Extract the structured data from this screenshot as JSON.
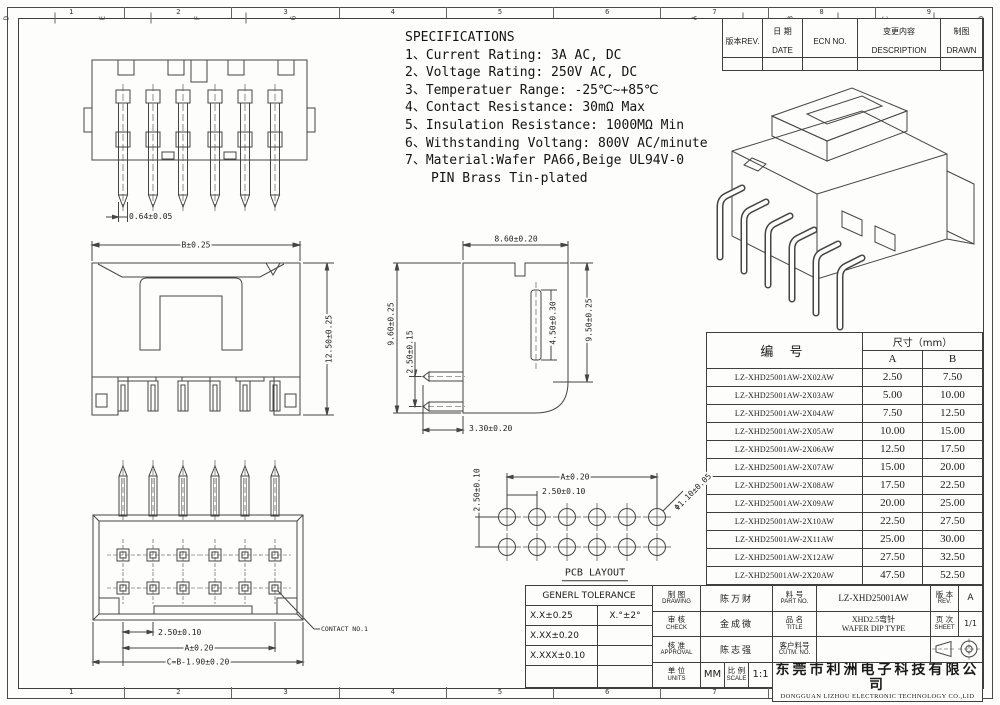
{
  "frame": {
    "cols": [
      "1",
      "2",
      "3",
      "4",
      "5",
      "6",
      "7",
      "8",
      "9"
    ],
    "rows": [
      "A",
      "B",
      "C",
      "D",
      "E",
      "F",
      "G"
    ]
  },
  "specs": {
    "title": "SPECIFICATIONS",
    "lines": [
      "1、Current Rating: 3A AC, DC",
      "2、Voltage Rating: 250V AC, DC",
      "3、Temperatuer Range: -25℃~+85℃",
      "4、Contact Resistance: 30mΩ Max",
      "5、Insulation Resistance: 1000MΩ Min",
      "6、Withstanding Voltang: 800V AC/minute",
      "7、Material:Wafer PA66,Beige UL94V-0",
      "PIN Brass Tin-plated"
    ]
  },
  "rev": {
    "cols": [
      {
        "zh": "版本",
        "en": "REV."
      },
      {
        "zh": "日 期",
        "en": "DATE"
      },
      {
        "zh": "",
        "en": "ECN NO."
      },
      {
        "zh": "变更内容",
        "en": "DESCRIPTION"
      },
      {
        "zh": "制图",
        "en": "DRAWN"
      }
    ]
  },
  "parts": {
    "header": {
      "part": "编  号",
      "dim": "尺寸（mm）",
      "a": "A",
      "b": "B"
    },
    "rows": [
      {
        "part": "LZ-XHD25001AW-2X02AW",
        "a": "2.50",
        "b": "7.50"
      },
      {
        "part": "LZ-XHD25001AW-2X03AW",
        "a": "5.00",
        "b": "10.00"
      },
      {
        "part": "LZ-XHD25001AW-2X04AW",
        "a": "7.50",
        "b": "12.50"
      },
      {
        "part": "LZ-XHD25001AW-2X05AW",
        "a": "10.00",
        "b": "15.00"
      },
      {
        "part": "LZ-XHD25001AW-2X06AW",
        "a": "12.50",
        "b": "17.50"
      },
      {
        "part": "LZ-XHD25001AW-2X07AW",
        "a": "15.00",
        "b": "20.00"
      },
      {
        "part": "LZ-XHD25001AW-2X08AW",
        "a": "17.50",
        "b": "22.50"
      },
      {
        "part": "LZ-XHD25001AW-2X09AW",
        "a": "20.00",
        "b": "25.00"
      },
      {
        "part": "LZ-XHD25001AW-2X10AW",
        "a": "22.50",
        "b": "27.50"
      },
      {
        "part": "LZ-XHD25001AW-2X11AW",
        "a": "25.00",
        "b": "30.00"
      },
      {
        "part": "LZ-XHD25001AW-2X12AW",
        "a": "27.50",
        "b": "32.50"
      },
      {
        "part": "LZ-XHD25001AW-2X20AW",
        "a": "47.50",
        "b": "52.50"
      }
    ]
  },
  "views": {
    "v1": {
      "pin_width": "0.64±0.05"
    },
    "v2": {
      "width": "B±0.25",
      "height": "12.50±0.25"
    },
    "v3": {
      "pitch": "2.50±0.10",
      "a": "A±0.20",
      "c": "C=B-1.90±0.20",
      "contact": "CONTACT NO.1"
    },
    "v4": {
      "top": "8.60±0.20",
      "left_outer": "9.60±0.25",
      "left_inner": "2.50±0.15",
      "mid": "4.50±0.30",
      "right": "9.50±0.25",
      "bottom": "3.30±0.20"
    },
    "v5": {
      "a": "A±0.20",
      "pitch_h": "2.50±0.10",
      "pitch_v": "2.50±0.10",
      "hole": "Φ1.10±0.05",
      "title": "PCB LAYOUT"
    }
  },
  "tb": {
    "tol": {
      "title": "GENERL TOLERANCE",
      "r1a": "X.X±0.25",
      "r1b": "X.°±2°",
      "r2a": "X.XX±0.20",
      "r3a": "X.XXX±0.10"
    },
    "roles": [
      {
        "zh": "制 图",
        "en": "DRAWING",
        "name": "陈万财"
      },
      {
        "zh": "审 核",
        "en": "CHECK",
        "name": "金成微"
      },
      {
        "zh": "核 准",
        "en": "APPROVAL",
        "name": "陈志强"
      }
    ],
    "units": {
      "zh": "单 位",
      "en": "UNITS",
      "val": "MM"
    },
    "scale": {
      "zh": "比 例",
      "en": "SCALE",
      "val": "1:1"
    },
    "part": {
      "zh": "料 号",
      "en": "PART NO.",
      "val": "LZ-XHD25001AW"
    },
    "rev": {
      "zh": "版 本",
      "en": "REV.",
      "val": "A"
    },
    "title": {
      "zh": "品 名",
      "en": "TITLE",
      "l1": "XHD2.5弯针",
      "l2": "WAFER DIP TYPE"
    },
    "sheet": {
      "zh": "页 次",
      "en": "SHEET",
      "val": "1/1"
    },
    "cust": {
      "zh": "客户料号",
      "en": "CUTM. NO."
    },
    "company": {
      "zh": "东莞市利洲电子科技有限公司",
      "en": "DONGGUAN LIZHOU ELECTRONIC TECHNOLOGY CO.,LID"
    }
  }
}
